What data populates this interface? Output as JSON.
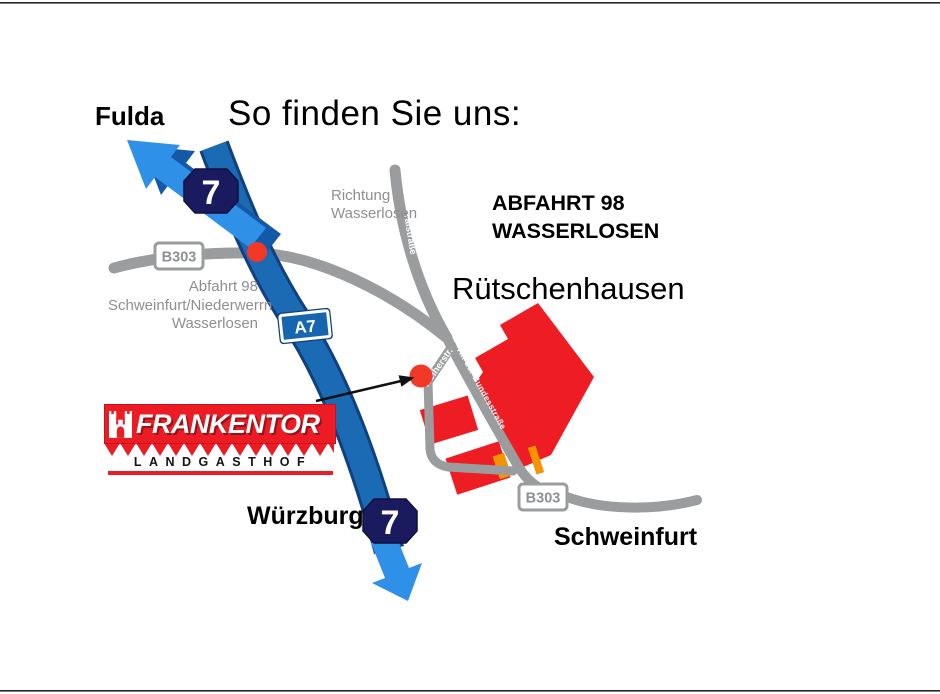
{
  "title": "So finden Sie uns:",
  "logo": {
    "name": "FRANKENTOR",
    "subtitle": "LANDGASTHOF"
  },
  "map": {
    "village_name": "Rütschenhausen",
    "destination_north": "Fulda",
    "destination_south": "Würzburg",
    "destination_east": "Schweinfurt",
    "autobahn_number": "7",
    "autobahn_label": "A7",
    "b_road_label": "B303",
    "direction_note": {
      "line1": "Richtung",
      "line2": "Wasserlosen"
    },
    "exit_note_west": {
      "line1": "Abfahrt 98",
      "line2": "Schweinfurt/Niederwerrn",
      "line3": "Wasserlosen"
    },
    "exit_note_east": {
      "line1": "ABFAHRT 98",
      "line2": "WASSERLOSEN"
    },
    "streets": {
      "talstrasse": "Talstraße",
      "an_der_bundesstrasse": "An der Bundesstraße",
      "weiherstrasse": "Weiherstr."
    }
  },
  "colors": {
    "autobahn_blue": "#1b6ab4",
    "autobahn_edge": "#10407f",
    "arrow_blue": "#2f90e8",
    "shield_navy": "#1a1b5e",
    "sign_blue": "#1565af",
    "road_gray": "#9b9c9e",
    "note_gray": "#8f8f91",
    "brand_red": "#ed1c24",
    "marker_red": "#f23827"
  }
}
